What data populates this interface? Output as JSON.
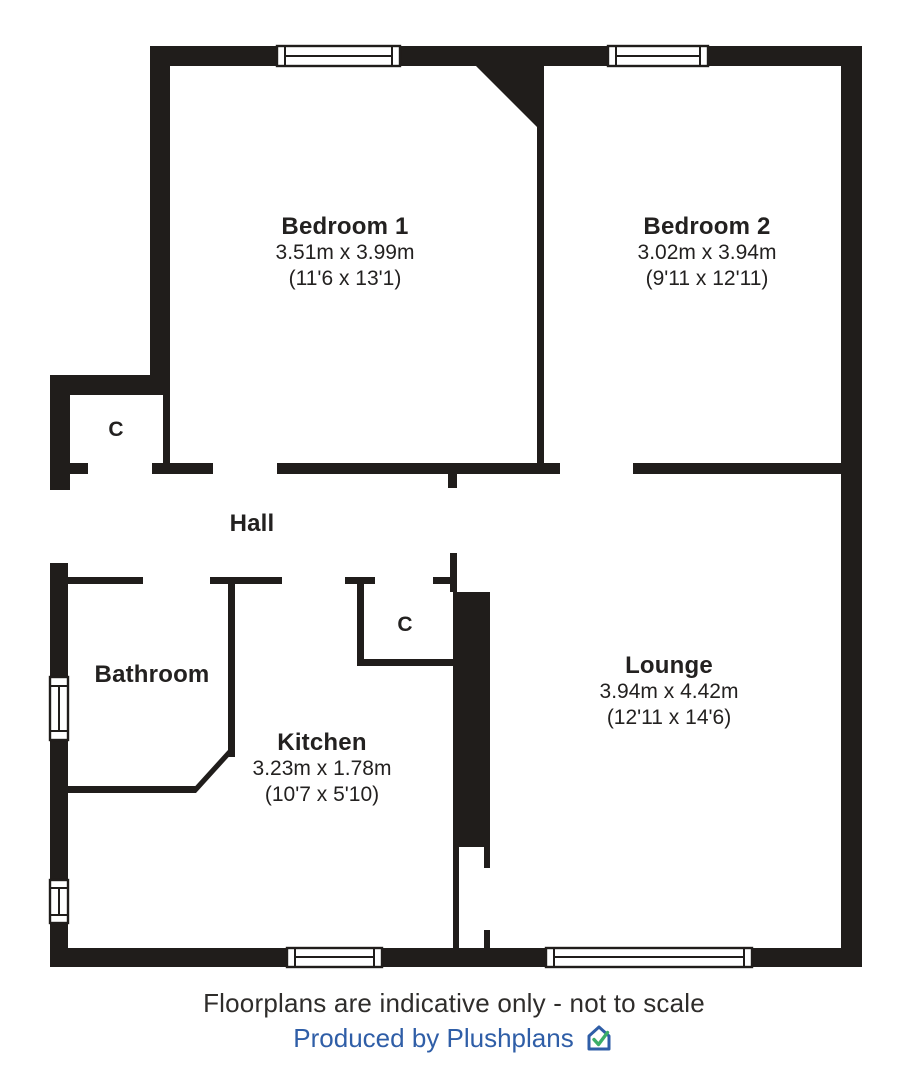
{
  "plan": {
    "rooms": {
      "bedroom1": {
        "name": "Bedroom 1",
        "metric": "3.51m x 3.99m",
        "imperial": "(11'6 x 13'1)"
      },
      "bedroom2": {
        "name": "Bedroom 2",
        "metric": "3.02m x 3.94m",
        "imperial": "(9'11 x 12'11)"
      },
      "hall": {
        "name": "Hall"
      },
      "bathroom": {
        "name": "Bathroom"
      },
      "kitchen": {
        "name": "Kitchen",
        "metric": "3.23m x 1.78m",
        "imperial": "(10'7 x 5'10)"
      },
      "lounge": {
        "name": "Lounge",
        "metric": "3.94m x 4.42m",
        "imperial": "(12'11 x 14'6)"
      }
    },
    "closets": [
      {
        "label": "C"
      },
      {
        "label": "C"
      }
    ],
    "colors": {
      "wall": "#201d1b",
      "floor": "#ffffff"
    }
  },
  "footer": {
    "disclaimer": "Floorplans are indicative only - not to scale",
    "credit": "Produced by Plushplans",
    "logo_icon": "house-check-logo",
    "colors": {
      "disclaimer_text": "#2f2d2b",
      "credit_text": "#2f5ea7",
      "logo_check": "#3cae68"
    }
  }
}
